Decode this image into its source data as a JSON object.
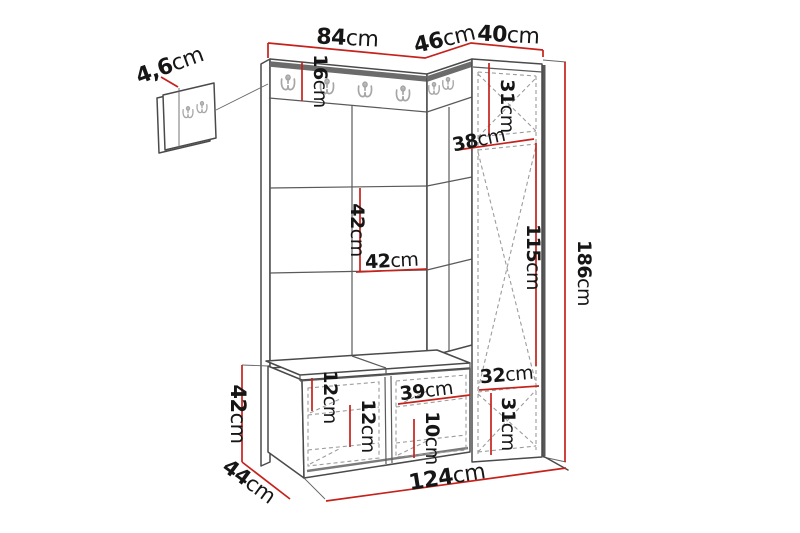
{
  "diagram": {
    "type": "furniture-dimension-diagram",
    "subject": "hallway wardrobe set with coat hooks, wall panels, tall cabinet and shoe bench",
    "unit_default": "cm",
    "colors": {
      "dimension_line": "#c5221c",
      "outline": "#4a4a4a",
      "hidden_line": "#9c9c9c",
      "top_rail": "#6b6b6b",
      "text": "#161616"
    }
  },
  "dims": {
    "panel_thickness": {
      "value": "4,6",
      "unit": "cm"
    },
    "front_width": {
      "value": "84",
      "unit": "cm"
    },
    "side_top_depth": {
      "value": "46",
      "unit": "cm"
    },
    "cabinet_width": {
      "value": "40",
      "unit": "cm"
    },
    "rail_height": {
      "value": "16",
      "unit": "cm"
    },
    "cabinet_top_section": {
      "value": "31",
      "unit": "cm"
    },
    "cabinet_depth": {
      "value": "38",
      "unit": "cm"
    },
    "panel_row_height": {
      "value": "42",
      "unit": "cm"
    },
    "panel_column_width": {
      "value": "42",
      "unit": "cm"
    },
    "cabinet_door_height": {
      "value": "115",
      "unit": "cm"
    },
    "total_height": {
      "value": "186",
      "unit": "cm"
    },
    "cabinet_inner_width": {
      "value": "32",
      "unit": "cm"
    },
    "cabinet_bottom_section": {
      "value": "31",
      "unit": "cm"
    },
    "bench_inner_width": {
      "value": "39",
      "unit": "cm"
    },
    "bench_inner_height": {
      "value": "10",
      "unit": "cm"
    },
    "bench_shelf_top": {
      "value": "12",
      "unit": "cm"
    },
    "bench_shelf_bottom": {
      "value": "12",
      "unit": "cm"
    },
    "bench_height": {
      "value": "42",
      "unit": "cm"
    },
    "bench_depth": {
      "value": "44",
      "unit": "cm"
    },
    "total_width": {
      "value": "124",
      "unit": "cm"
    }
  }
}
